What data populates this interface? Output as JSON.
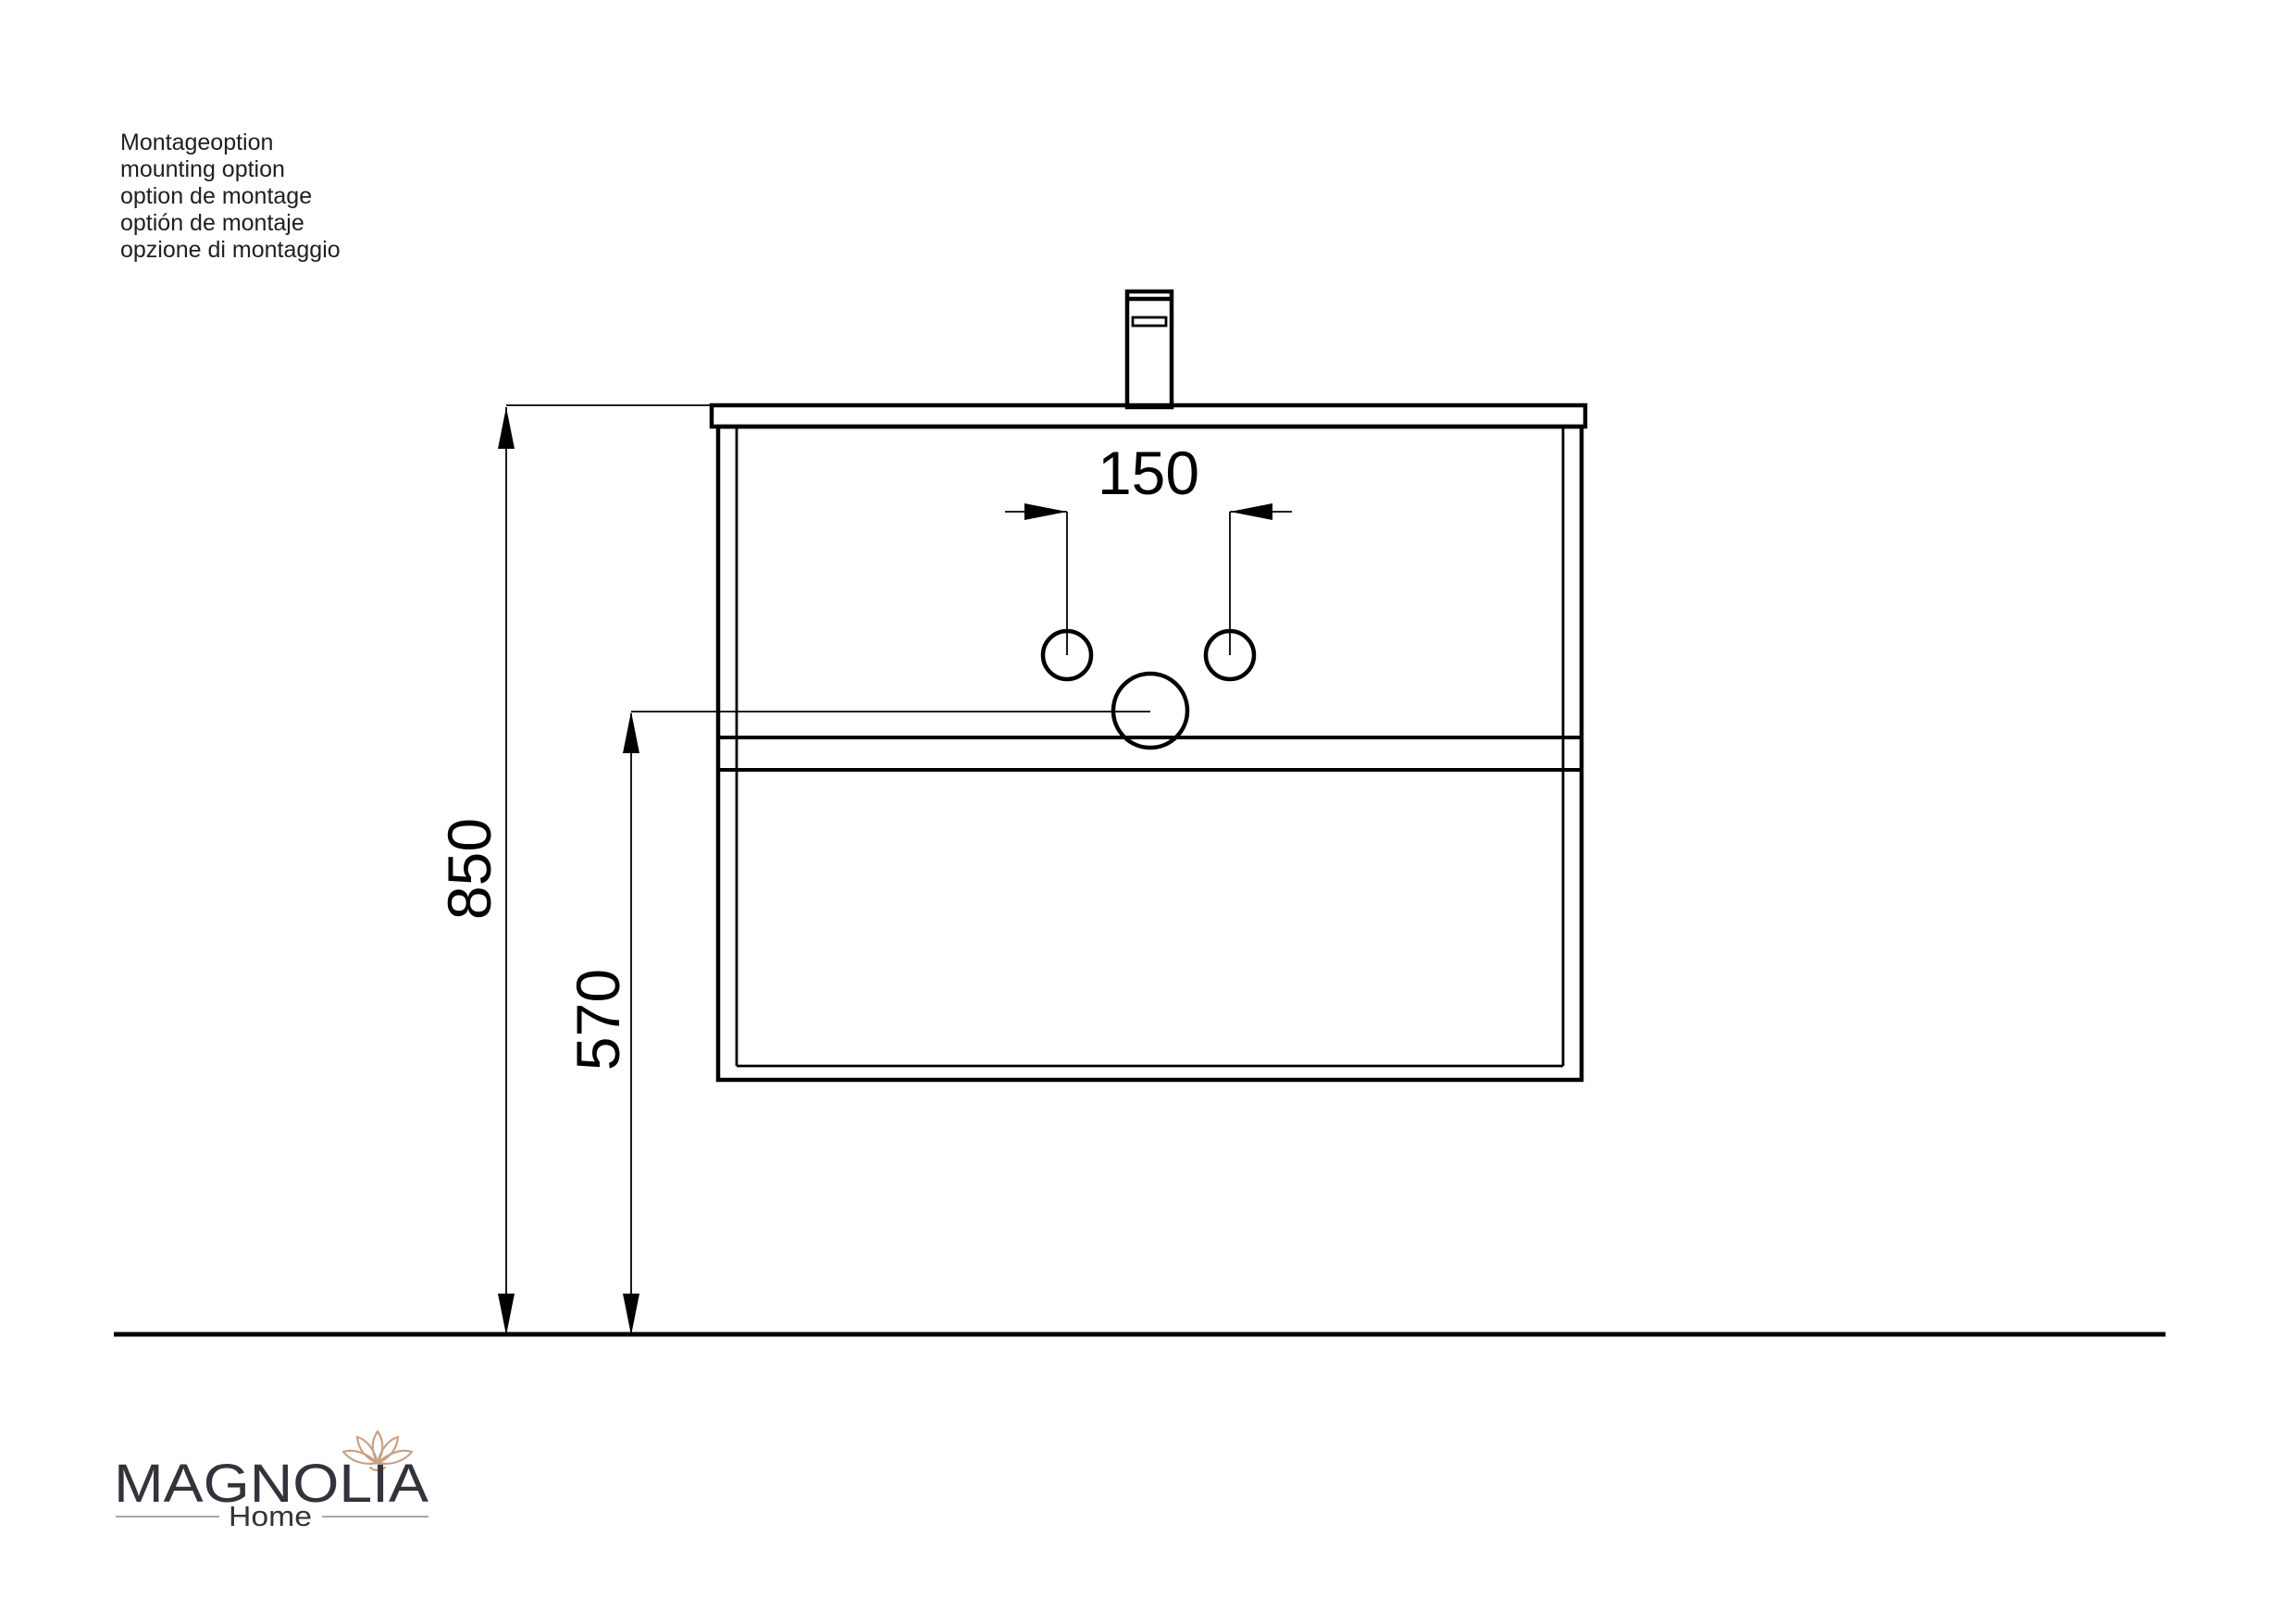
{
  "colors": {
    "ink": "#000000",
    "annotation-ink": "#1f1f1f",
    "logo-text": "#34333c",
    "logo-flower": "#c9a183",
    "logo-rule": "#a6a6a6",
    "background": "#ffffff"
  },
  "annotation": {
    "lines": [
      "Montageoption",
      "mounting option",
      "option de montage",
      "optión de montaje",
      "opzione di montaggio"
    ]
  },
  "dimensions": {
    "hole_spacing": "150",
    "total_height": "850",
    "clearance_height": "570"
  },
  "logo": {
    "brand": "MAGNOLIA",
    "subtitle": "Home"
  }
}
